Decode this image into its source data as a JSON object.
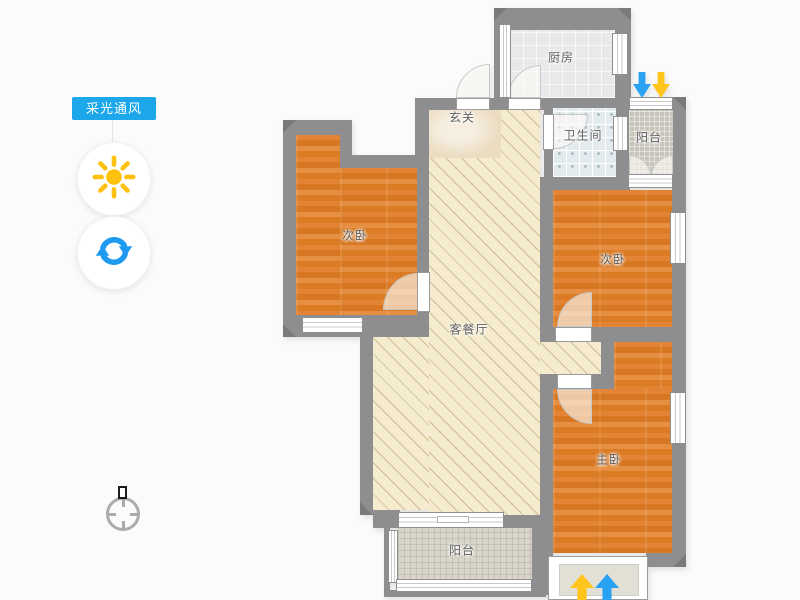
{
  "app": {
    "title": "户型图 采光通风",
    "background": "#fbfbfb"
  },
  "sidebar": {
    "mode_label": "采光通风",
    "mode_label_bg": "#1ba7e9",
    "mode_label_color": "#ffffff",
    "daylight_button": {
      "icon": "sun-icon",
      "color": "#fec20e"
    },
    "ventilation_button": {
      "icon": "refresh-icon",
      "color": "#1e9af0"
    }
  },
  "floorplan": {
    "wall_color": "#8e8e90",
    "floor_colors": {
      "wood": "#e0812e",
      "living_hatch": "#f5eccf",
      "entry_marble": "#ecdcc0",
      "kitchen_tile": "#e9e9eb",
      "bath_tile": "#e4ebee",
      "balcony_mosaic_top": "#c8c4ba",
      "balcony_mosaic_bottom": "#d9d5ca"
    },
    "rooms": [
      {
        "id": "kitchen",
        "label": "厨房"
      },
      {
        "id": "entry-hall",
        "label": "玄关"
      },
      {
        "id": "bathroom",
        "label": "卫生间"
      },
      {
        "id": "balcony-top",
        "label": "阳台"
      },
      {
        "id": "bedroom-left",
        "label": "次卧"
      },
      {
        "id": "living-dining",
        "label": "客餐厅"
      },
      {
        "id": "bedroom-right",
        "label": "次卧"
      },
      {
        "id": "master-bedroom",
        "label": "主卧"
      },
      {
        "id": "balcony-bottom",
        "label": "阳台"
      }
    ],
    "airflow": {
      "top_arrows": [
        {
          "direction": "down",
          "color": "#2aa2f3"
        },
        {
          "direction": "down",
          "color": "#ffc51c"
        }
      ],
      "bottom_arrows": [
        {
          "direction": "up",
          "color": "#ffc51c"
        },
        {
          "direction": "up",
          "color": "#2aa2f3"
        }
      ]
    },
    "compass": {
      "icon": "compass-icon"
    }
  }
}
